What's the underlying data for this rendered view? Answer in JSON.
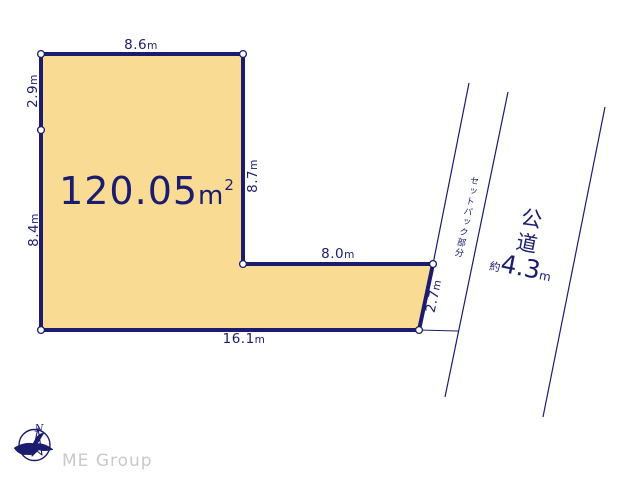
{
  "colors": {
    "navy": "#1b1b70",
    "plot_fill": "#f9db94",
    "watermark": "#c9c9c9"
  },
  "plot": {
    "area": {
      "value": "120.05",
      "unit": "m",
      "exponent": "2"
    },
    "dimensions": {
      "top": {
        "value": "8.6",
        "unit": "m"
      },
      "left_upper": {
        "value": "2.9",
        "unit": "m"
      },
      "left_lower": {
        "value": "8.4",
        "unit": "m"
      },
      "inner_vertical": {
        "value": "8.7",
        "unit": "m"
      },
      "inner_horizontal": {
        "value": "8.0",
        "unit": "m"
      },
      "right_slant": {
        "value": "2.7",
        "unit": "m"
      },
      "bottom": {
        "value": "16.1",
        "unit": "m"
      }
    }
  },
  "road": {
    "setback_label": "セットバック部分",
    "name": "公道",
    "width_prefix": "約",
    "width_value": "4.3",
    "width_unit": "m"
  },
  "compass": {
    "north_label": "N"
  },
  "watermark": "ME Group"
}
